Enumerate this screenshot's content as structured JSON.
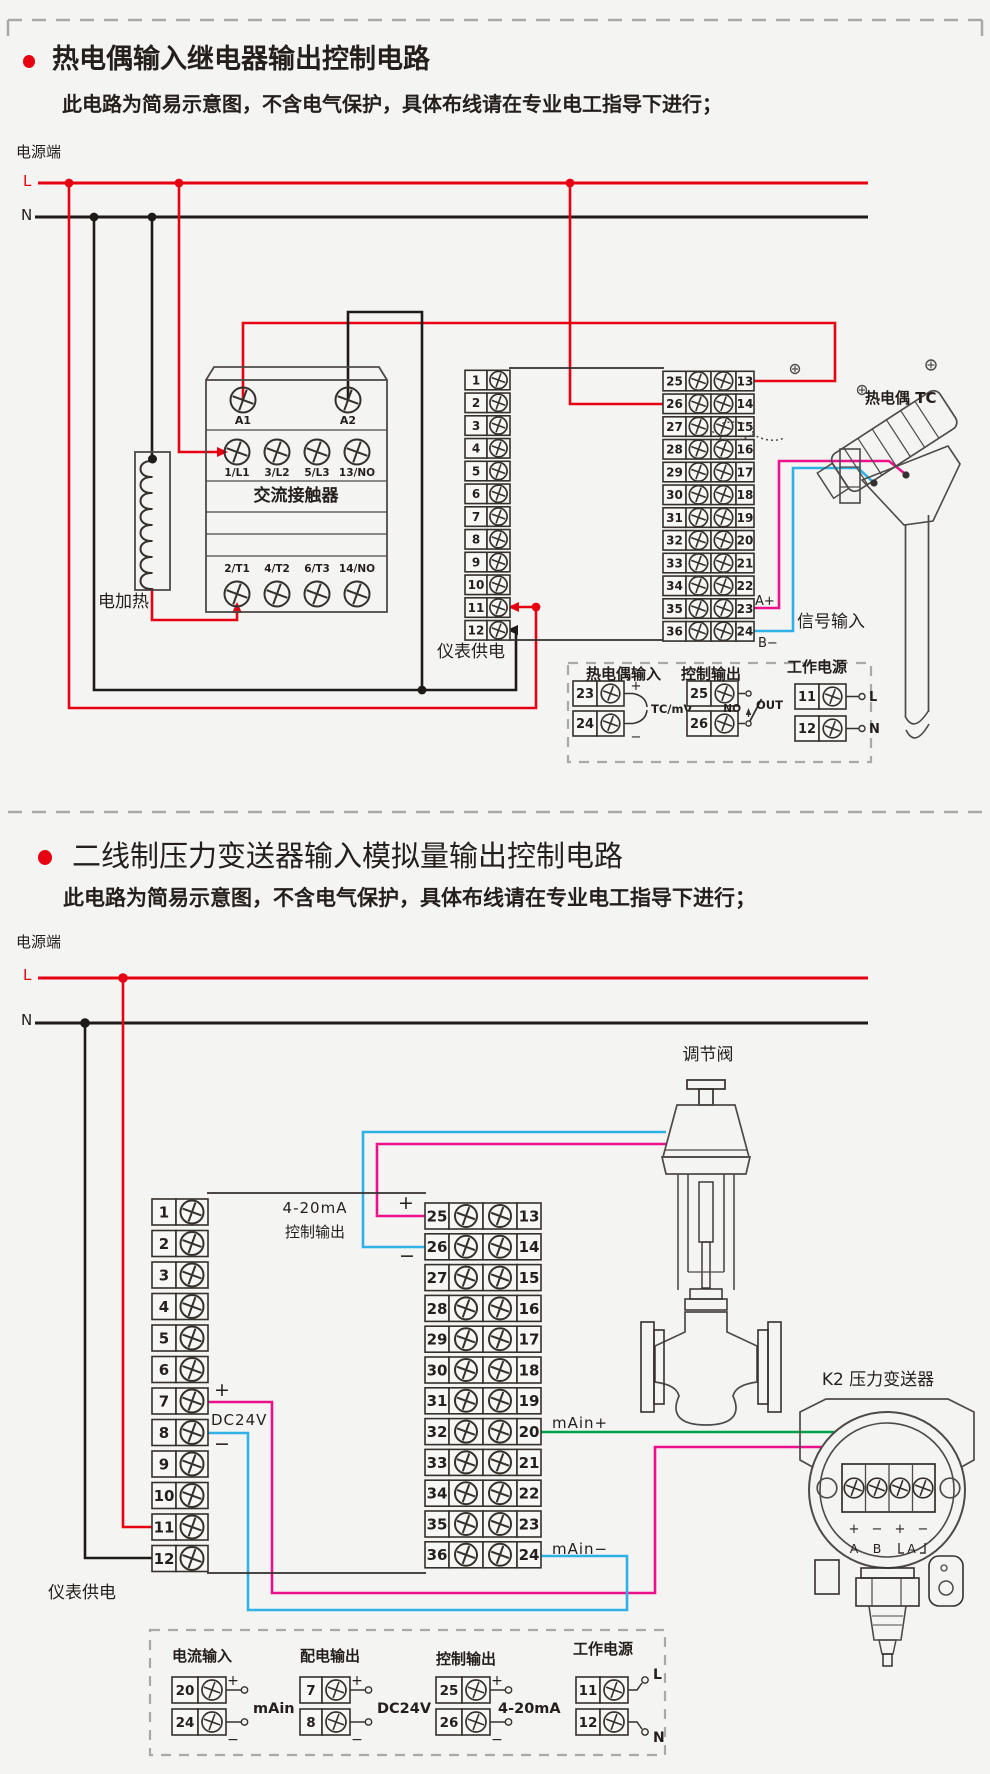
{
  "palette": {
    "red": "#e60012",
    "black": "#1e1a17",
    "magenta": "#ec108c",
    "blue": "#2fb1e8",
    "green": "#00a14b",
    "line": "#34302c",
    "art": "#4d4a47",
    "dash": "#a9a9a7",
    "bg": "#f4f4f2"
  },
  "circuit1": {
    "title": "热电偶输入继电器输出控制电路",
    "subtitle": "此电路为简易示意图，不含电气保护，具体布线请在专业电工指导下进行；",
    "power_label": "电源端",
    "line_l": "L",
    "line_n": "N",
    "heater": "电加热",
    "contactor": {
      "label": "交流接触器",
      "coil_pins": [
        "A1",
        "A2"
      ],
      "input_pins": [
        "1/L1",
        "3/L2",
        "5/L3",
        "13/NO"
      ],
      "output_pins": [
        "2/T1",
        "4/T2",
        "6/T3",
        "14/NO"
      ]
    },
    "meter_supply": "仪表供电",
    "signal_input": "信号输入",
    "a_plus": "A+",
    "b_minus": "B−",
    "thermocouple": "热电偶 TC",
    "terminals": {
      "left": [
        "1",
        "2",
        "3",
        "4",
        "5",
        "6",
        "7",
        "8",
        "9",
        "10",
        "11",
        "12"
      ],
      "mid_left": [
        "25",
        "26",
        "27",
        "28",
        "29",
        "30",
        "31",
        "32",
        "33",
        "34",
        "35",
        "36"
      ],
      "mid_right": [
        "13",
        "14",
        "15",
        "16",
        "17",
        "18",
        "19",
        "20",
        "21",
        "22",
        "23",
        "24"
      ]
    },
    "legend": {
      "tc_input": {
        "header": "热电偶输入",
        "terminals": [
          "23",
          "24"
        ],
        "signs": [
          "+",
          "−"
        ],
        "note": "TC/mV"
      },
      "control_output": {
        "header": "控制输出",
        "terminals": [
          "25",
          "26"
        ],
        "no": "NO",
        "out": "OUT"
      },
      "working_power": {
        "header": "工作电源",
        "terminals": [
          "11",
          "12"
        ],
        "signs": [
          "L",
          "N"
        ]
      }
    }
  },
  "circuit2": {
    "title": "二线制压力变送器输入模拟量输出控制电路",
    "subtitle": "此电路为简易示意图，不含电气保护，具体布线请在专业电工指导下进行；",
    "power_label": "电源端",
    "line_l": "L",
    "line_n": "N",
    "valve": "调节阀",
    "output_note_1": "4-20mA",
    "output_note_2": "控制输出",
    "plus_25": "+",
    "minus_26": "−",
    "plus_7": "+",
    "dc24v": "DC24V",
    "minus_8": "−",
    "main_plus": "mAin+",
    "main_minus": "mAin−",
    "transmitter": "K2 压力变送器",
    "transmitter_pins": [
      "+",
      "−",
      "+",
      "−"
    ],
    "transmitter_ports": [
      "A",
      "B",
      "A"
    ],
    "meter_supply": "仪表供电",
    "terminals": {
      "left": [
        "1",
        "2",
        "3",
        "4",
        "5",
        "6",
        "7",
        "8",
        "9",
        "10",
        "11",
        "12"
      ],
      "mid_left": [
        "25",
        "26",
        "27",
        "28",
        "29",
        "30",
        "31",
        "32",
        "33",
        "34",
        "35",
        "36"
      ],
      "mid_right": [
        "13",
        "14",
        "15",
        "16",
        "17",
        "18",
        "19",
        "20",
        "21",
        "22",
        "23",
        "24"
      ]
    },
    "legend": {
      "current_input": {
        "header": "电流输入",
        "terminals": [
          "20",
          "24"
        ],
        "signs": [
          "+",
          "−"
        ],
        "note": "mAin"
      },
      "dist_output": {
        "header": "配电输出",
        "terminals": [
          "7",
          "8"
        ],
        "signs": [
          "+",
          "−"
        ],
        "note": "DC24V"
      },
      "control_output": {
        "header": "控制输出",
        "terminals": [
          "25",
          "26"
        ],
        "signs": [
          "+",
          "−"
        ],
        "note": "4-20mA"
      },
      "working_power": {
        "header": "工作电源",
        "terminals": [
          "11",
          "12"
        ],
        "signs": [
          "L",
          "N"
        ]
      }
    }
  }
}
